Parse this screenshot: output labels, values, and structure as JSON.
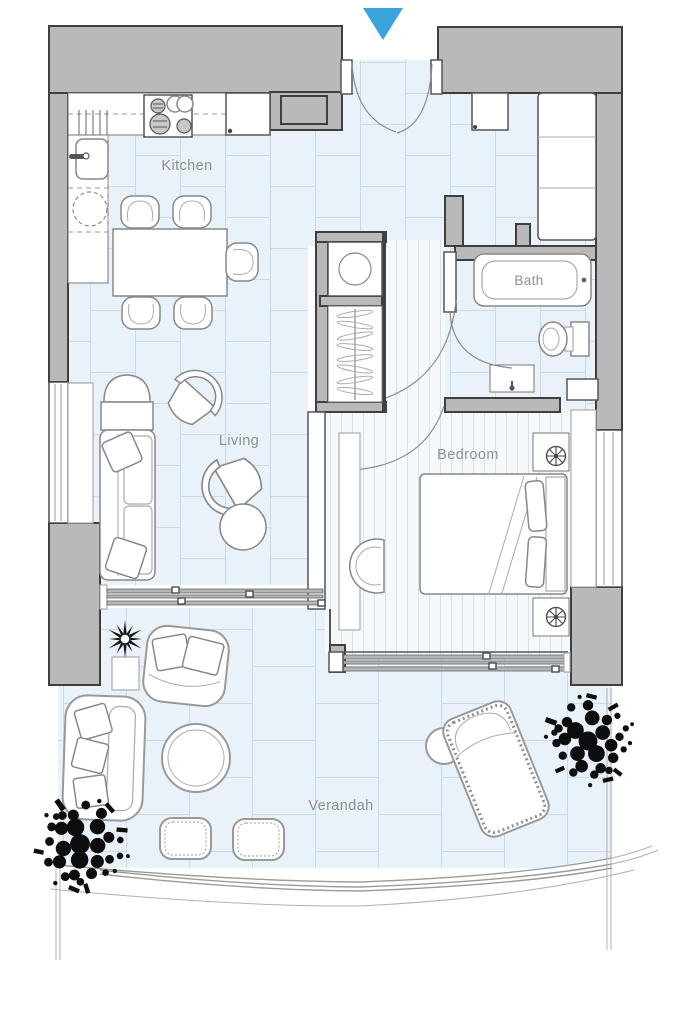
{
  "page": {
    "background": "#ffffff"
  },
  "plan": {
    "type": "apartment-floor-plan",
    "entry_marker": {
      "icon": "entry-arrow-down-icon",
      "color": "#3aa5dd"
    },
    "rooms": {
      "kitchen": {
        "label": "Kitchen"
      },
      "living": {
        "label": "Living"
      },
      "bath": {
        "label": "Bath"
      },
      "bedroom": {
        "label": "Bedroom"
      },
      "verandah": {
        "label": "Verandah"
      }
    },
    "colors": {
      "accent": "#3aa5dd",
      "wall": "#b9b9b9",
      "wall_outline": "#3f3f3f",
      "tile_floor": "#eaf2f9",
      "tile_line": "#ccdae7",
      "stripe_floor": "#f5f9fc",
      "stripe_line": "#d8e2eb",
      "label": "#8f8f8f",
      "tree": "#0d0d0d"
    }
  }
}
